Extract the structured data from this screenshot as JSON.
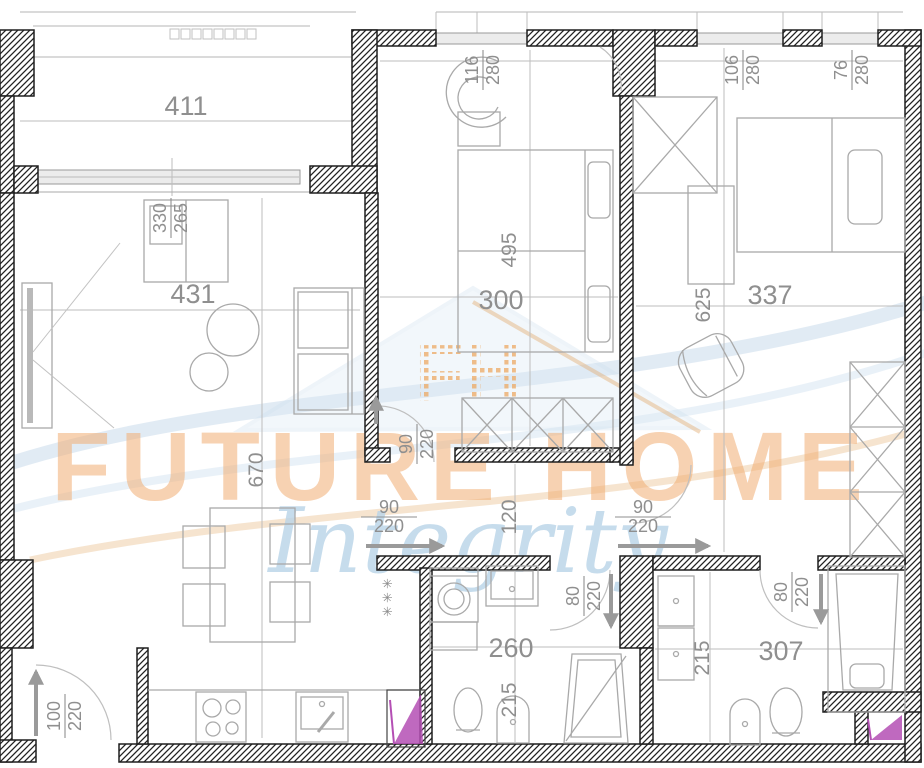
{
  "document": {
    "kind": "apartment floor plan drawing"
  },
  "watermark": {
    "line1": "FUTURE HOME",
    "line2": "Integrity",
    "monogram": "FH",
    "orange": "#f2ae74",
    "blue": "#b9d4e8"
  },
  "symbols": {
    "closet_stars": "✳✳✳"
  },
  "colors": {
    "wall": "#1f1f1f",
    "dim_text": "#8f8f8f",
    "furniture": "#a9a9a9",
    "duct_highlight": "#b44fb4"
  },
  "dims": {
    "balcony_w": "411",
    "living_w": "431",
    "living_h": "670",
    "cabinet": {
      "num": "330",
      "den": "265"
    },
    "bedroom_mid_w": "300",
    "bedroom_mid_h": "495",
    "bedroom_right_w": "337",
    "bedroom_right_h": "625",
    "hall_w": "120",
    "bath_center_w": "260",
    "bath_center_h": "215",
    "bath_right_w": "307",
    "bath_right_h": "215",
    "win_mid": {
      "num": "116",
      "den": "280"
    },
    "win_right1": {
      "num": "106",
      "den": "280"
    },
    "win_right2": {
      "num": "76",
      "den": "280"
    },
    "door_mid": {
      "num": "90",
      "den": "220"
    },
    "door_hall_left": {
      "num": "90",
      "den": "220"
    },
    "door_hall_right": {
      "num": "90",
      "den": "220"
    },
    "door_bath_center": {
      "num": "80",
      "den": "220"
    },
    "door_bath_right": {
      "num": "80",
      "den": "220"
    },
    "door_entry": {
      "num": "100",
      "den": "220"
    }
  }
}
